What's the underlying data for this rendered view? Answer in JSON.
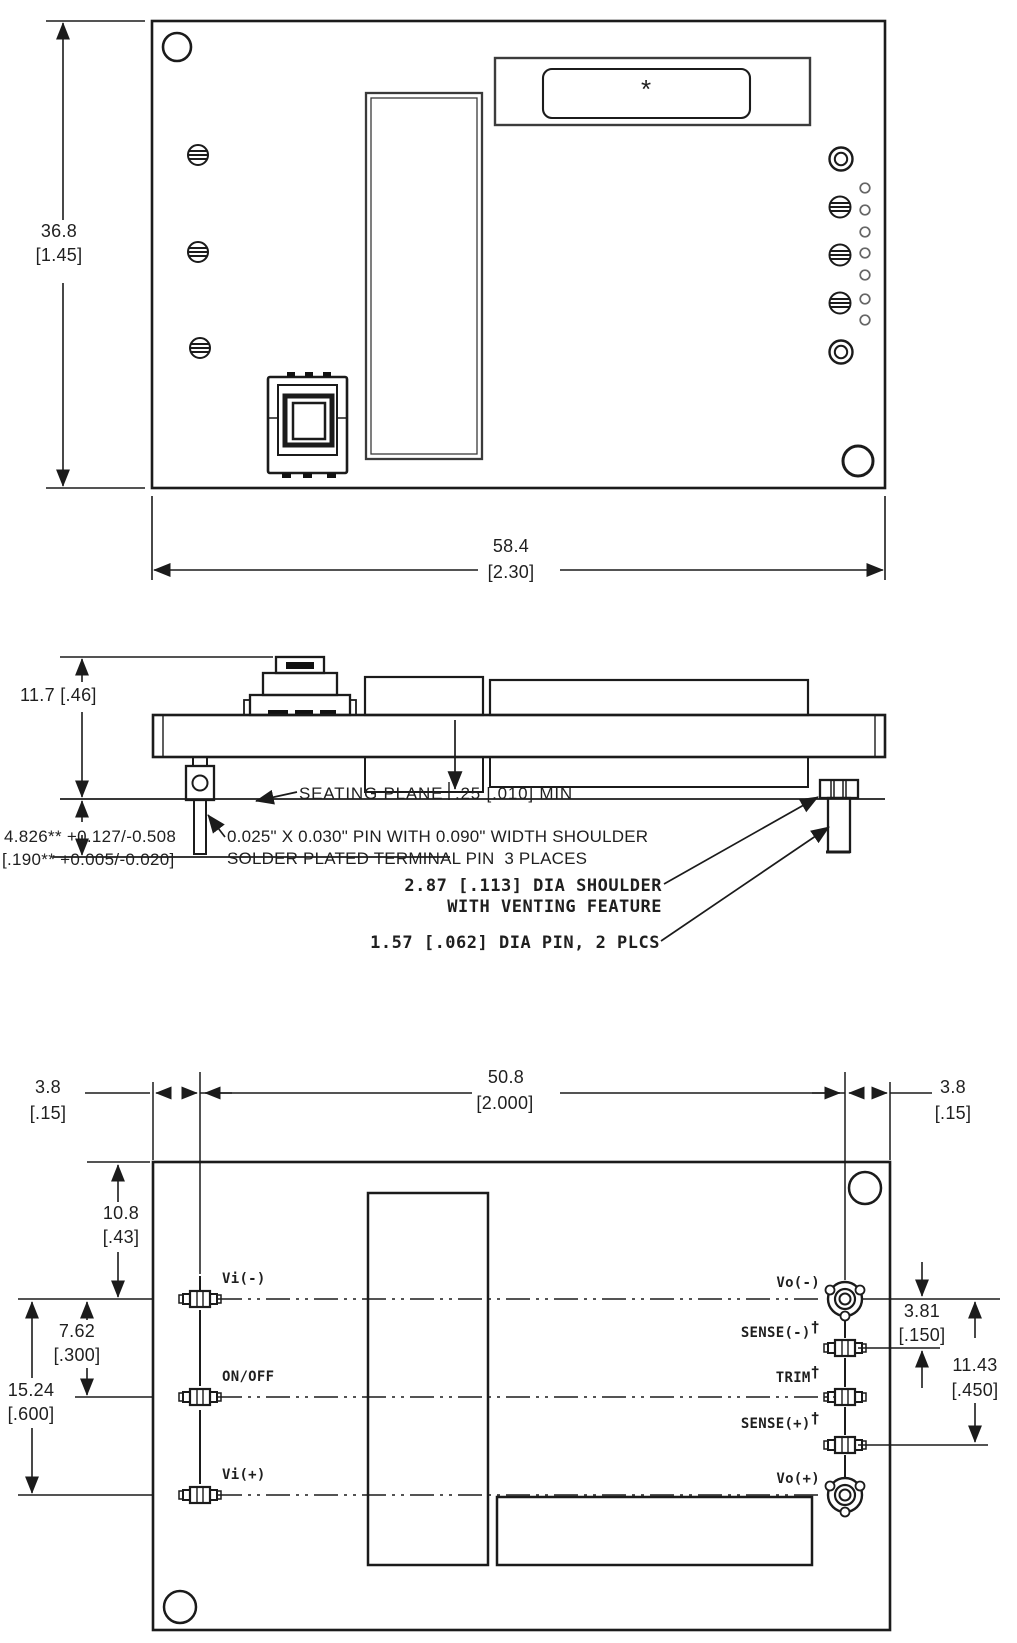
{
  "drawing_type": "mechanical outline drawing, 3 views (top, side, bottom)",
  "colors": {
    "line": "#1b1b1b",
    "background": "#ffffff"
  },
  "top_view": {
    "height_mm": "36.8",
    "height_in": "[1.45]",
    "width_mm": "58.4",
    "width_in": "[2.30]",
    "marking": "*"
  },
  "side_view": {
    "height": "11.7 [.46]",
    "pin_len_mm": "4.826** +0.127/-0.508",
    "pin_len_in": "[.190** +0.005/-0.020]",
    "seating": "SEATING PLANE",
    "clearance": ".25 [.010] MIN",
    "pin_note1": "0.025\" X 0.030\" PIN WITH 0.090\" WIDTH SHOULDER",
    "pin_note2": "SOLDER PLATED TERMINAL PIN  3 PLACES",
    "shoulder_note1": "2.87 [.113] DIA SHOULDER",
    "shoulder_note2": "WITH VENTING FEATURE",
    "round_pin_note": "1.57 [.062] DIA PIN, 2 PLCS"
  },
  "bottom_view": {
    "left_offset_mm": "3.8",
    "left_offset_in": "[.15]",
    "pin_span_mm": "50.8",
    "pin_span_in": "[2.000]",
    "right_offset_mm": "3.8",
    "right_offset_in": "[.15]",
    "top_offset_mm": "10.8",
    "top_offset_in": "[.43]",
    "row_pitch_mm": "7.62",
    "row_pitch_in": "[.300]",
    "row_span_mm": "15.24",
    "row_span_in": "[.600]",
    "sense_offset_mm": "3.81",
    "sense_offset_in": "[.150]",
    "sense_span_mm": "11.43",
    "sense_span_in": "[.450]",
    "pins_left": [
      {
        "label": "Vi(-)",
        "sup": ""
      },
      {
        "label": "ON/OFF",
        "sup": ""
      },
      {
        "label": "Vi(+)",
        "sup": ""
      }
    ],
    "pins_right": [
      {
        "label": "Vo(-)",
        "sup": ""
      },
      {
        "label": "SENSE(-)",
        "sup": "†"
      },
      {
        "label": "TRIM",
        "sup": "†"
      },
      {
        "label": "SENSE(+)",
        "sup": "†"
      },
      {
        "label": "Vo(+)",
        "sup": ""
      }
    ]
  }
}
